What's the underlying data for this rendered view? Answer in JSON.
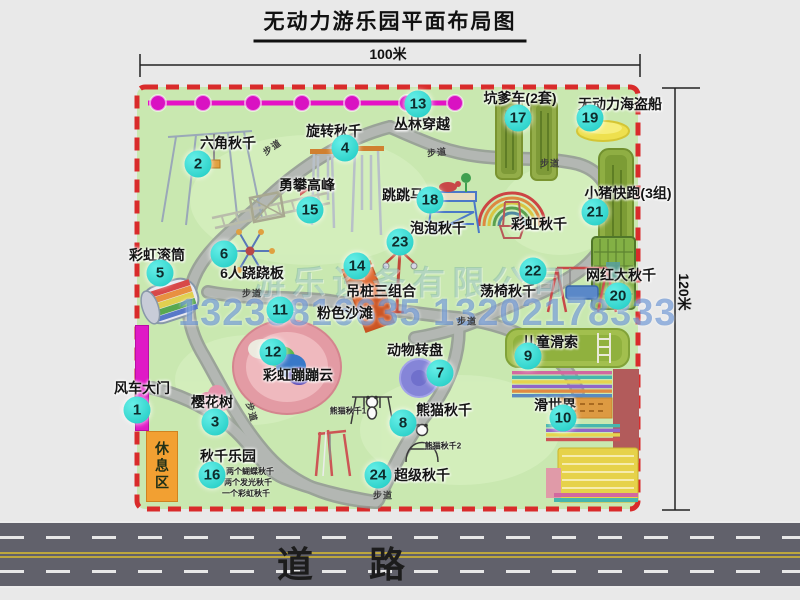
{
  "title": "无动力游乐园平面布局图",
  "dimensions": {
    "width_label": "100米",
    "height_label": "120米"
  },
  "road": {
    "label": "道 路"
  },
  "watermark": {
    "company": "游乐设备有限公司",
    "phone": "13233816635 13202178333"
  },
  "park": {
    "path_label": "步道",
    "rest_area_label": "休息区"
  },
  "colors": {
    "park_green": "#c9e8b0",
    "border_red": "#d92b2b",
    "zipline_magenta": "#e012c6",
    "badge_cyan": "#1cc9c1",
    "road_gray": "#61616b",
    "gate_magenta": "#df1ac6",
    "rest_orange": "#f2a032"
  },
  "attractions": [
    {
      "num": "1",
      "label": "风车大门"
    },
    {
      "num": "2",
      "label": "六角秋千"
    },
    {
      "num": "3",
      "label": "樱花树"
    },
    {
      "num": "4",
      "label": "旋转秋千"
    },
    {
      "num": "5",
      "label": "彩虹滚筒"
    },
    {
      "num": "6",
      "label": "6人跷跷板"
    },
    {
      "num": "7",
      "label": "动物转盘"
    },
    {
      "num": "8",
      "label": "熊猫秋千",
      "sublabels": [
        "熊猫秋千1",
        "熊猫秋千2"
      ]
    },
    {
      "num": "9",
      "label": "儿童滑索"
    },
    {
      "num": "10",
      "label": "滑世界"
    },
    {
      "num": "11",
      "label": "粉色沙滩"
    },
    {
      "num": "12",
      "label": "彩虹蹦蹦云"
    },
    {
      "num": "13",
      "label": "丛林穿越"
    },
    {
      "num": "14",
      "label": "吊桩三组合"
    },
    {
      "num": "15",
      "label": "勇攀高峰"
    },
    {
      "num": "16",
      "label": "秋千乐园",
      "sublabels": [
        "两个蝴蝶秋千",
        "两个发光秋千",
        "一个彩虹秋千"
      ]
    },
    {
      "num": "17",
      "label": "坑爹车(2套)"
    },
    {
      "num": "18",
      "label": "跳跳马"
    },
    {
      "num": "19",
      "label": "无动力海盗船"
    },
    {
      "num": "20",
      "label": "网红大秋千"
    },
    {
      "num": "21",
      "label": "小猪快跑(3组)"
    },
    {
      "num": "22",
      "label": "荡椅秋千"
    },
    {
      "num": "23",
      "label": "泡泡秋千"
    },
    {
      "num": "24",
      "label": "超级秋千"
    },
    {
      "num": "",
      "label": "彩虹秋千"
    }
  ]
}
